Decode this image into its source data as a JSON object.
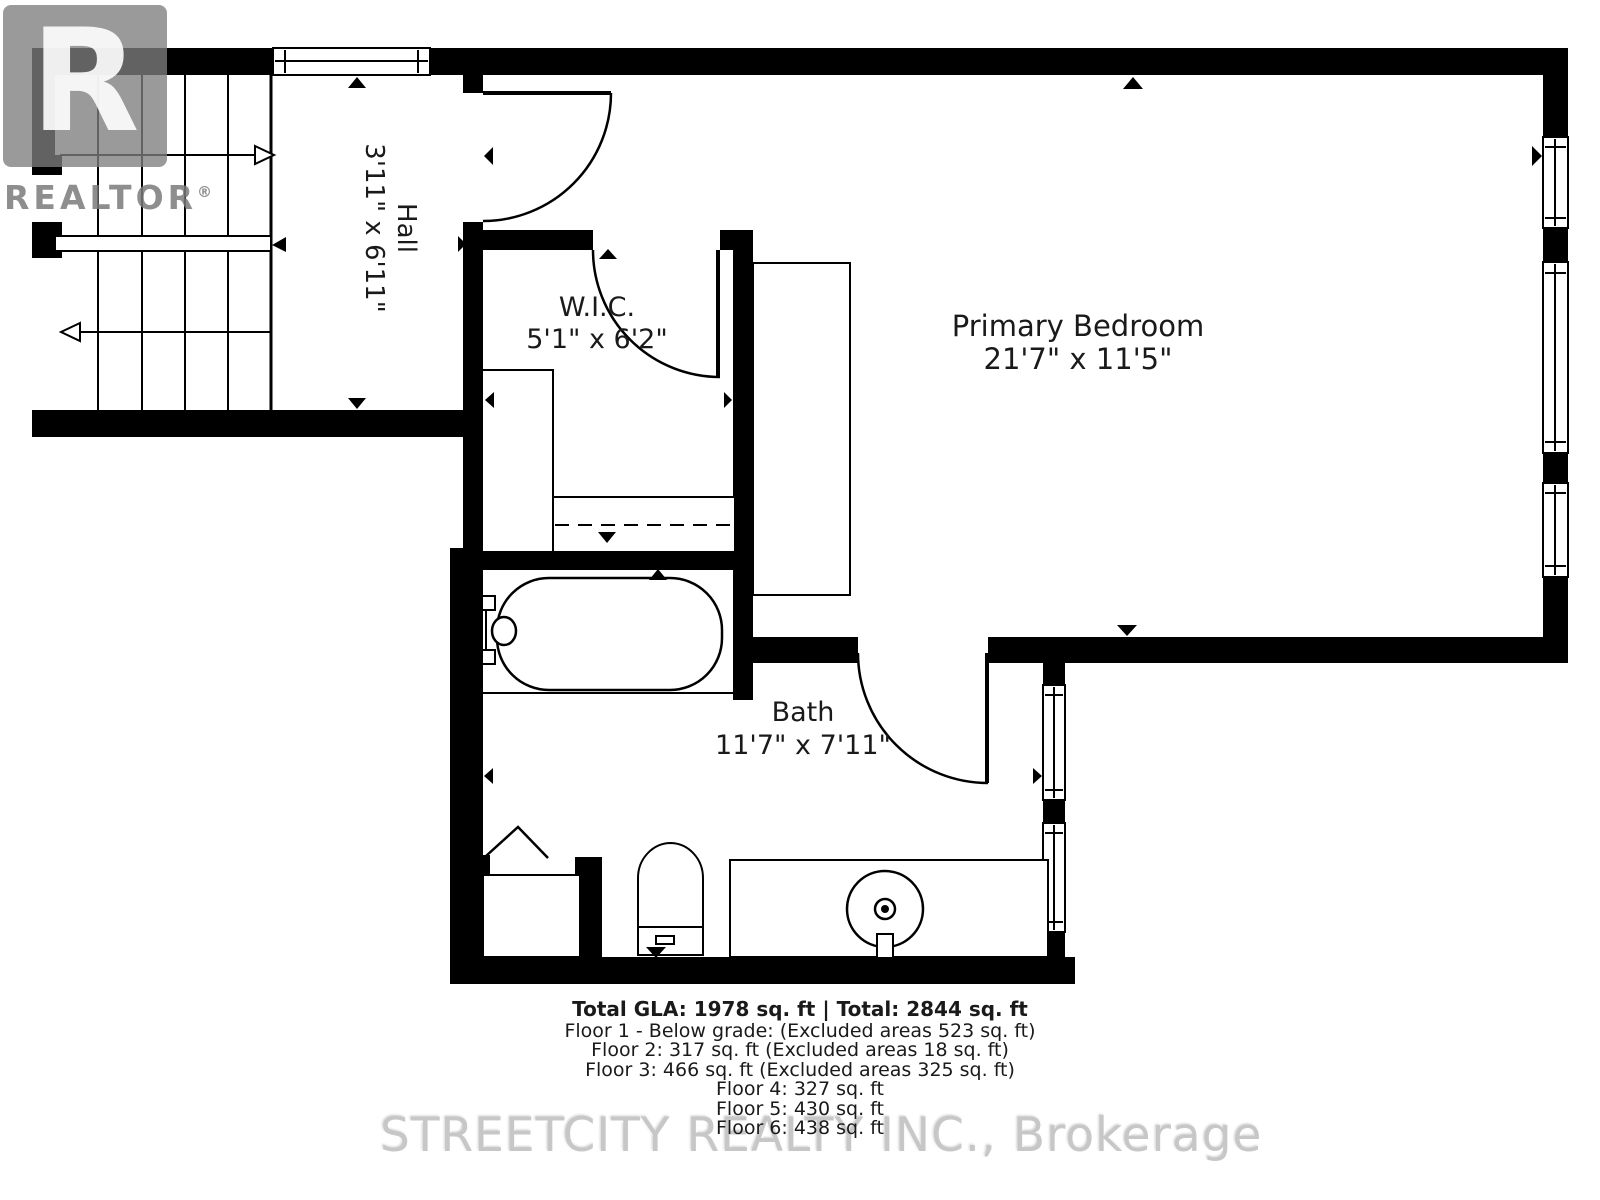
{
  "branding": {
    "logo_letter": "R",
    "logo_text": "REALTOR",
    "reg_mark": "®",
    "watermark": "STREETCITY REALTY INC., Brokerage"
  },
  "rooms": {
    "hall": {
      "name": "Hall",
      "dimensions": "3'11\" x 6'11\""
    },
    "wic": {
      "name": "W.I.C.",
      "dimensions": "5'1\" x 6'2\""
    },
    "primary_bedroom": {
      "name": "Primary Bedroom",
      "dimensions": "21'7\" x 11'5\""
    },
    "bath": {
      "name": "Bath",
      "dimensions": "11'7\" x 7'11\""
    }
  },
  "summary": {
    "total": "Total GLA: 1978 sq. ft | Total: 2844 sq. ft",
    "floors": [
      "Floor 1 - Below grade: (Excluded areas 523 sq. ft)",
      "Floor 2: 317 sq. ft (Excluded areas 18 sq. ft)",
      "Floor 3: 466 sq. ft (Excluded areas 325 sq. ft)",
      "Floor 4: 327 sq. ft",
      "Floor 5: 430 sq. ft",
      "Floor 6: 438 sq. ft"
    ]
  },
  "colors": {
    "wall": "#000000",
    "background": "#ffffff",
    "watermark_gray": "#c7c7c7"
  }
}
